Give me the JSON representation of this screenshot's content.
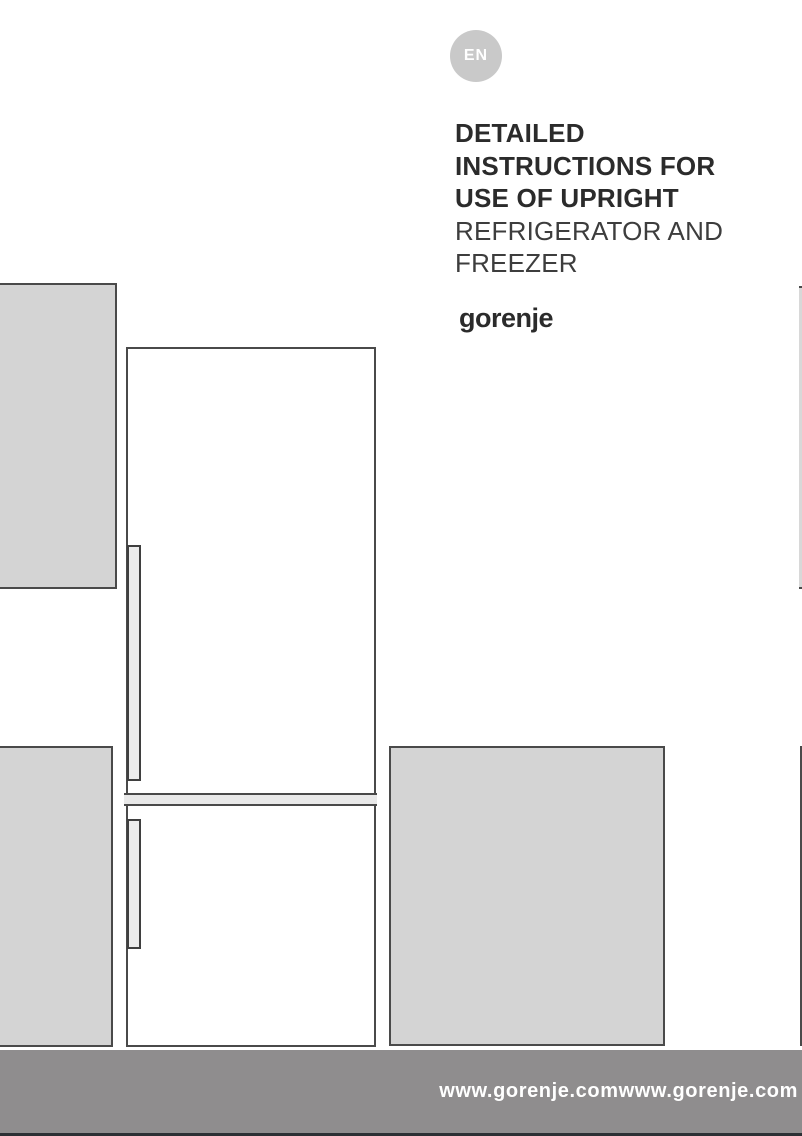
{
  "page": {
    "language_badge": "EN",
    "title": {
      "bold_lines": [
        "DETAILED",
        "INSTRUCTIONS FOR",
        "USE OF UPRIGHT"
      ],
      "regular_lines": [
        "REFRIGERATOR AND",
        "FREEZER"
      ]
    },
    "brand_logo": "gorenje",
    "illustration": {
      "description": "line drawing of upright refrigerator-freezer between gray cabinet panels",
      "parts": [
        "cabinet-panel-top-left",
        "cabinet-panel-bottom-left",
        "cabinet-panel-right",
        "fridge-outline",
        "fridge-door-divider",
        "upper-door-handle",
        "lower-door-handle",
        "right-edge-panel-top",
        "right-edge-panel-bottom"
      ]
    },
    "footer": {
      "website_text": "www.gorenje.comwww.gorenje.com"
    },
    "colors": {
      "badge_bg": "#c9c9c9",
      "badge_text": "#ffffff",
      "title_text": "#2b2b2b",
      "subtitle_text": "#3d3d3d",
      "shape_fill_gray": "#d4d4d4",
      "shape_fill_light": "#e9e9e9",
      "shape_border": "#4a4a4a",
      "footer_bg": "#8f8d8e",
      "footer_text": "#ffffff",
      "footer_strip": "#2c3034"
    }
  }
}
